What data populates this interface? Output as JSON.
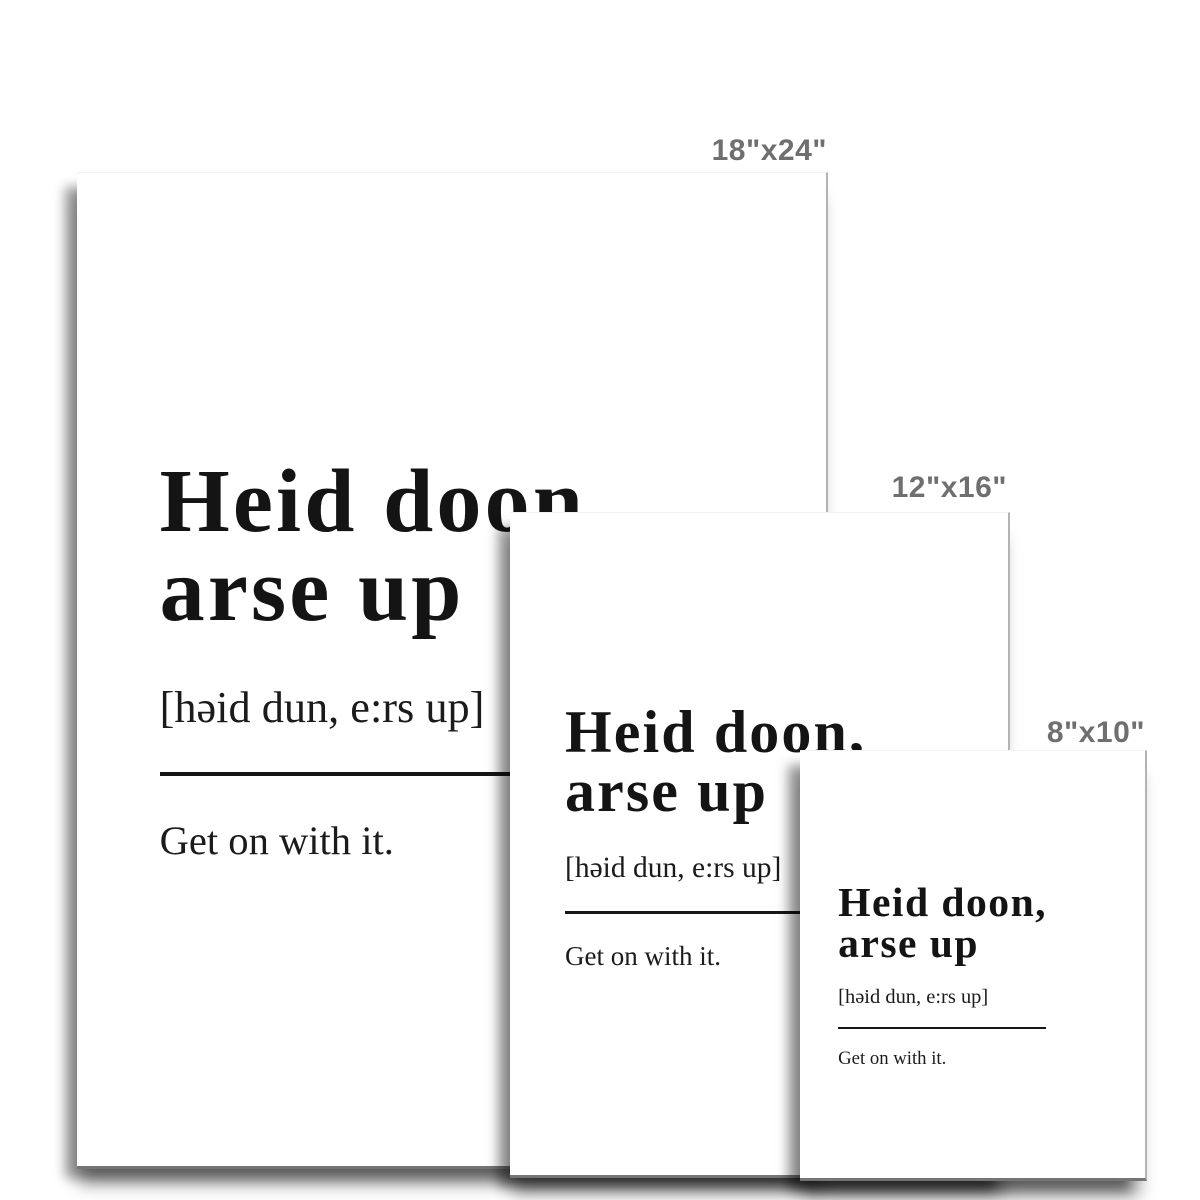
{
  "page": {
    "background": "#ffffff",
    "description_label": "poster size comparison mockup"
  },
  "sizes": [
    {
      "id": "18x24",
      "label": "18\"x24\""
    },
    {
      "id": "12x16",
      "label": "12\"x16\""
    },
    {
      "id": "8x10",
      "label": "8\"x10\""
    }
  ],
  "poster": {
    "title_line1": "Heid doon,",
    "title_line2": "arse up",
    "phonetic": "[həid dun, e:rs up]",
    "definition": "Get on with it."
  },
  "colors": {
    "poster_text": "#141414",
    "size_label_text": "#6f6f6f",
    "poster_right_edge": "#b3b3b3",
    "poster_bottom_edge": "#757575",
    "divider": "#161616",
    "shadow": "rgba(0,0,0,0.4)"
  }
}
